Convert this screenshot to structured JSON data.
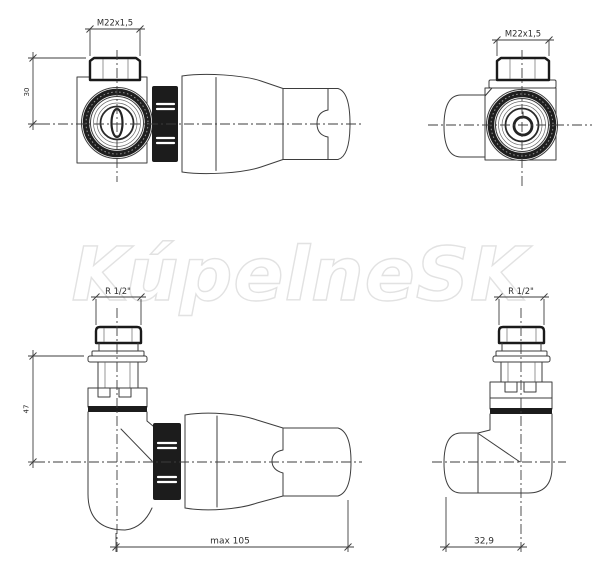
{
  "watermark": {
    "text": "KúpelneSK"
  },
  "views": {
    "top_left": {
      "thread_label": "M22x1,5",
      "height_label": "30"
    },
    "top_right": {
      "thread_label": "M22x1,5"
    },
    "bottom_left": {
      "thread_label": "R 1/2\"",
      "height_label": "47",
      "length_label": "max 105"
    },
    "bottom_right": {
      "thread_label": "R 1/2\"",
      "width_label": "32,9"
    }
  },
  "colors": {
    "line": "#3d3d3d",
    "dark_fill": "#1c1c1c",
    "dimension_text": "#2e2e2e",
    "watermark": "#e2e2e2",
    "background": "#ffffff"
  }
}
